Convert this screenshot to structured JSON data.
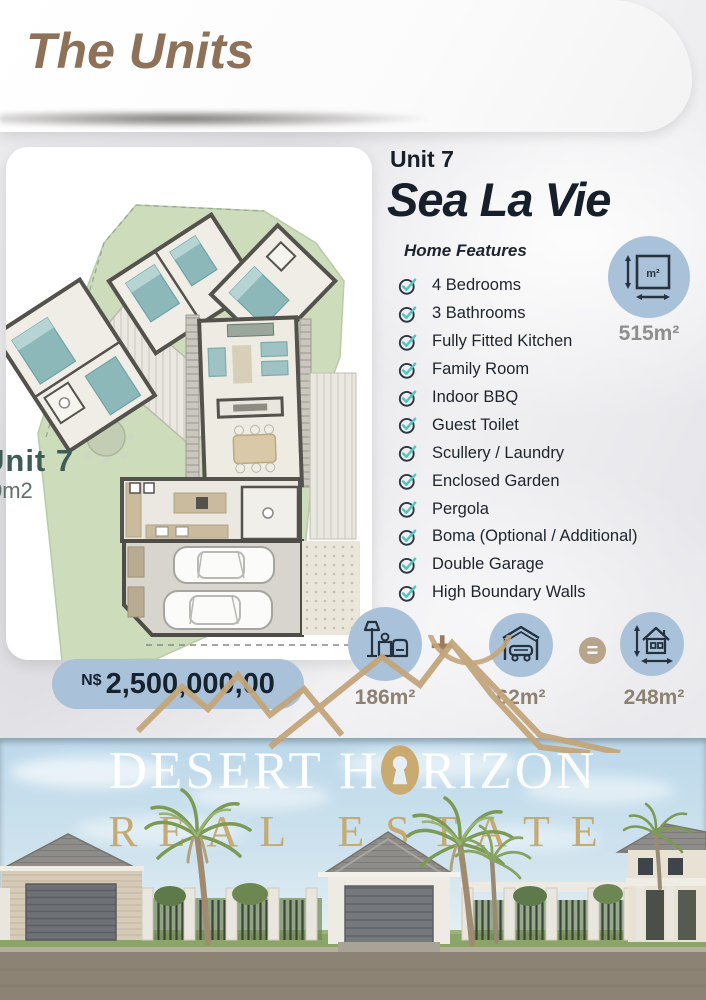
{
  "header": {
    "title": "The Units"
  },
  "plan": {
    "unit_label": "Unit 7",
    "area_partial": "0m2"
  },
  "unit": {
    "label": "Unit 7",
    "name": "Sea La Vie",
    "features_heading": "Home Features",
    "features": [
      "4 Bedrooms",
      "3 Bathrooms",
      "Fully Fitted Kitchen",
      "Family Room",
      "Indoor BBQ",
      "Guest Toilet",
      "Scullery / Laundry",
      "Enclosed Garden",
      "Pergola",
      "Boma (Optional / Additional)",
      "Double Garage",
      "High Boundary Walls"
    ],
    "stand_size": "515m²",
    "stand_icon_label": "m²"
  },
  "price": {
    "currency": "N$",
    "amount": "2,500,000,00"
  },
  "area_summary": {
    "house_area": "186m²",
    "plus": "+",
    "garage_area": "62m²",
    "equals": "=",
    "total_area": "248m²"
  },
  "brand": {
    "line1_left": "DESERT H",
    "line1_right": "RIZON",
    "line2": "REAL ESTATE"
  },
  "colors": {
    "accent_blue": "#a9c2da",
    "check_teal": "#53c6bd",
    "title_brown": "#8d7159",
    "brand_gold": "#c4a76a",
    "navy": "#23313f",
    "label_tan": "#8d8172"
  }
}
